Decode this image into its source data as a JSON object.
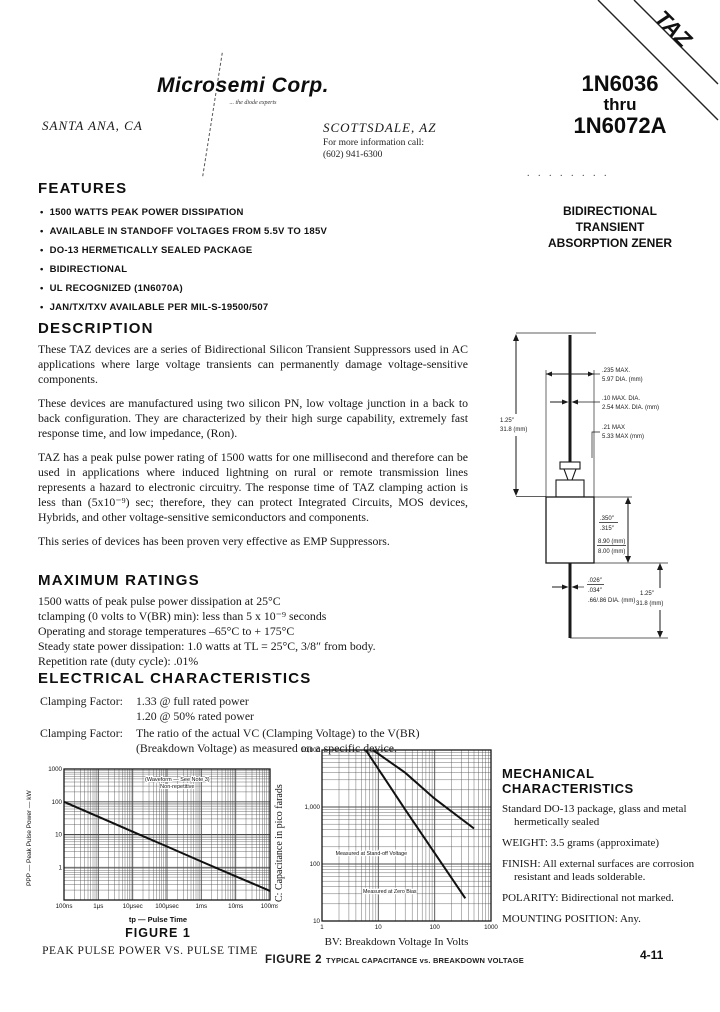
{
  "page": {
    "number": "4-11"
  },
  "header": {
    "logo": "Microsemi Corp.",
    "tagline": "... the diode experts",
    "location_left": "SANTA ANA, CA",
    "location_right": "SCOTTSDALE, AZ",
    "contact_line1": "For more information call:",
    "contact_line2": "(602) 941-6300",
    "part_line1": "1N6036",
    "part_line2": "thru",
    "part_line3": "1N6072A",
    "banner_text": "TAZ",
    "dots": ". . . . . . .   .",
    "subtitle_lines": [
      "BIDIRECTIONAL",
      "TRANSIENT",
      "ABSORPTION ZENER"
    ]
  },
  "features": {
    "title": "FEATURES",
    "bullet_glyph": "•",
    "items": [
      "1500 WATTS PEAK POWER DISSIPATION",
      "AVAILABLE IN STANDOFF VOLTAGES FROM 5.5V TO 185V",
      "DO-13 HERMETICALLY SEALED PACKAGE",
      "BIDIRECTIONAL",
      "UL RECOGNIZED (1N6070A)",
      "JAN/TX/TXV AVAILABLE PER MIL-S-19500/507"
    ]
  },
  "description": {
    "title": "DESCRIPTION",
    "paragraphs": [
      "These TAZ devices are a series of Bidirectional Silicon Transient Suppressors used in AC applications where large voltage transients can permanently damage voltage-sensitive components.",
      "These devices are manufactured using two silicon PN, low voltage junction in a back to back configuration. They are characterized by their high surge capability, extremely fast response time, and low impedance, (Ron).",
      "TAZ has a peak pulse power rating of 1500 watts for one millisecond and therefore can be used in applications where induced lightning on rural or remote transmission lines represents a hazard to electronic circuitry. The response time of TAZ clamping action is less than (5x10⁻⁹) sec; therefore, they can protect Integrated Circuits, MOS devices, Hybrids, and other voltage-sensitive semiconductors and components.",
      "This series of devices has been proven very effective as EMP Suppressors."
    ]
  },
  "maximum_ratings": {
    "title": "MAXIMUM RATINGS",
    "lines": [
      "1500 watts of peak pulse power dissipation at 25°C",
      "tclamping (0 volts to V(BR) min): less than 5 x 10⁻⁹ seconds",
      "Operating and storage temperatures –65°C to + 175°C",
      "Steady state power dissipation: 1.0 watts at TL = 25°C, 3/8″ from body.",
      "Repetition rate (duty cycle): .01%"
    ]
  },
  "electrical": {
    "title": "ELECTRICAL CHARACTERISTICS",
    "row1_label": "Clamping Factor:",
    "row1_value1": "1.33 @ full rated power",
    "row1_value2": "1.20 @ 50% rated power",
    "row2_label": "Clamping Factor:",
    "row2_value": "The ratio of the actual VC (Clamping Voltage) to the V(BR) (Breakdown Voltage) as measured on a specific device."
  },
  "package_diagram": {
    "labels": {
      "lead_len_top_in": "1.25″",
      "lead_len_top_mm": "31.8 (mm)",
      "body_dia_in": ".235 MAX.",
      "body_dia_mm": "5.97 DIA. (mm)",
      "lead_dia_in": ".10 MAX. DIA.",
      "lead_dia_mm": "2.54 MAX. DIA. (mm)",
      "neck_in": ".21 MAX",
      "neck_mm": "5.33 MAX (mm)",
      "body_len_in_a": ".350″",
      "body_len_in_b": ".315″",
      "body_len_mm_a": "8.90 (mm)",
      "body_len_mm_b": "8.00 (mm)",
      "lead2_dia_a": ".026″",
      "lead2_dia_b": ".034″",
      "lead2_dia_mm": ".66/.86 DIA. (mm)",
      "lead_len_bot_in": "1.25″",
      "lead_len_bot_mm": "31.8 (mm)"
    }
  },
  "mechanical": {
    "title_line1": "MECHANICAL",
    "title_line2": "CHARACTERISTICS",
    "items": [
      "Standard DO-13 package, glass and metal hermetically sealed",
      "WEIGHT: 3.5 grams (approximate)",
      "FINISH: All external surfaces are corrosion resistant and leads solderable.",
      "POLARITY: Bidirectional not marked.",
      "MOUNTING POSITION: Any."
    ]
  },
  "figures": {
    "fig1": {
      "ylabel": "PPP — Peak Pulse Power — kW",
      "xlabel": "tp — Pulse Time",
      "caption": "FIGURE 1",
      "subcaption": "PEAK PULSE POWER VS. PULSE TIME"
    },
    "fig2": {
      "ylabel": "C: Capacitance in pico farads",
      "xlabel": "BV: Breakdown Voltage In Volts",
      "caption": "FIGURE 2",
      "subcaption": "TYPICAL CAPACITANCE vs. BREAKDOWN VOLTAGE"
    }
  },
  "chart_data": [
    {
      "id": "fig1",
      "type": "line",
      "title": "PEAK PULSE POWER VS. PULSE TIME",
      "xlabel": "tp — Pulse Time (seconds)",
      "ylabel": "Peak Pulse Power (kW)",
      "x_scale": "log",
      "y_scale": "log",
      "xlim": [
        1e-07,
        0.1
      ],
      "ylim": [
        0.1,
        1000
      ],
      "grid": true,
      "x_ticks": [
        1e-07,
        1e-06,
        1e-05,
        0.0001,
        0.001,
        0.01,
        0.1
      ],
      "x_tick_labels": [
        "100ns",
        "1μs",
        "10μsec",
        "100μsec",
        "1ms",
        "10ms",
        "100ms"
      ],
      "y_ticks": [
        1000,
        100,
        10,
        1
      ],
      "y_tick_labels": [
        "1000",
        "100",
        "10",
        "1"
      ],
      "annotation_lines": [
        "(Waveform — See Note 3)",
        "Non-repetitive"
      ],
      "annotation_at": [
        0.0002,
        430
      ],
      "series": [
        {
          "name": "Peak pulse power",
          "points": [
            [
              1e-07,
              100
            ],
            [
              1e-06,
              35
            ],
            [
              1e-05,
              12.2
            ],
            [
              0.0001,
              4.3
            ],
            [
              0.001,
              1.5
            ],
            [
              0.01,
              0.53
            ],
            [
              0.1,
              0.19
            ]
          ]
        }
      ]
    },
    {
      "id": "fig2",
      "type": "line",
      "title": "TYPICAL CAPACITANCE vs. BREAKDOWN VOLTAGE",
      "xlabel": "BV: Breakdown Voltage In Volts",
      "ylabel": "C: Capacitance in pico farads",
      "x_scale": "log",
      "y_scale": "log",
      "xlim": [
        1,
        1000
      ],
      "ylim": [
        10,
        10000
      ],
      "grid": true,
      "x_ticks": [
        1,
        10,
        100,
        1000
      ],
      "x_tick_labels": [
        "1",
        "10",
        "100",
        "1000"
      ],
      "y_ticks": [
        10000,
        1000,
        100,
        10
      ],
      "y_tick_labels": [
        "10,000",
        "1,000",
        "100",
        "10"
      ],
      "series": [
        {
          "name": "Measured at Zero Bias",
          "points": [
            [
              8,
              10000
            ],
            [
              30,
              4000
            ],
            [
              100,
              1400
            ],
            [
              500,
              420
            ]
          ],
          "label_at": [
            16,
            31
          ]
        },
        {
          "name": "Measured at Stand-off Voltage",
          "points": [
            [
              6,
              10000
            ],
            [
              30,
              900
            ],
            [
              350,
              25
            ]
          ],
          "label_at": [
            7.5,
            145
          ]
        }
      ]
    }
  ]
}
